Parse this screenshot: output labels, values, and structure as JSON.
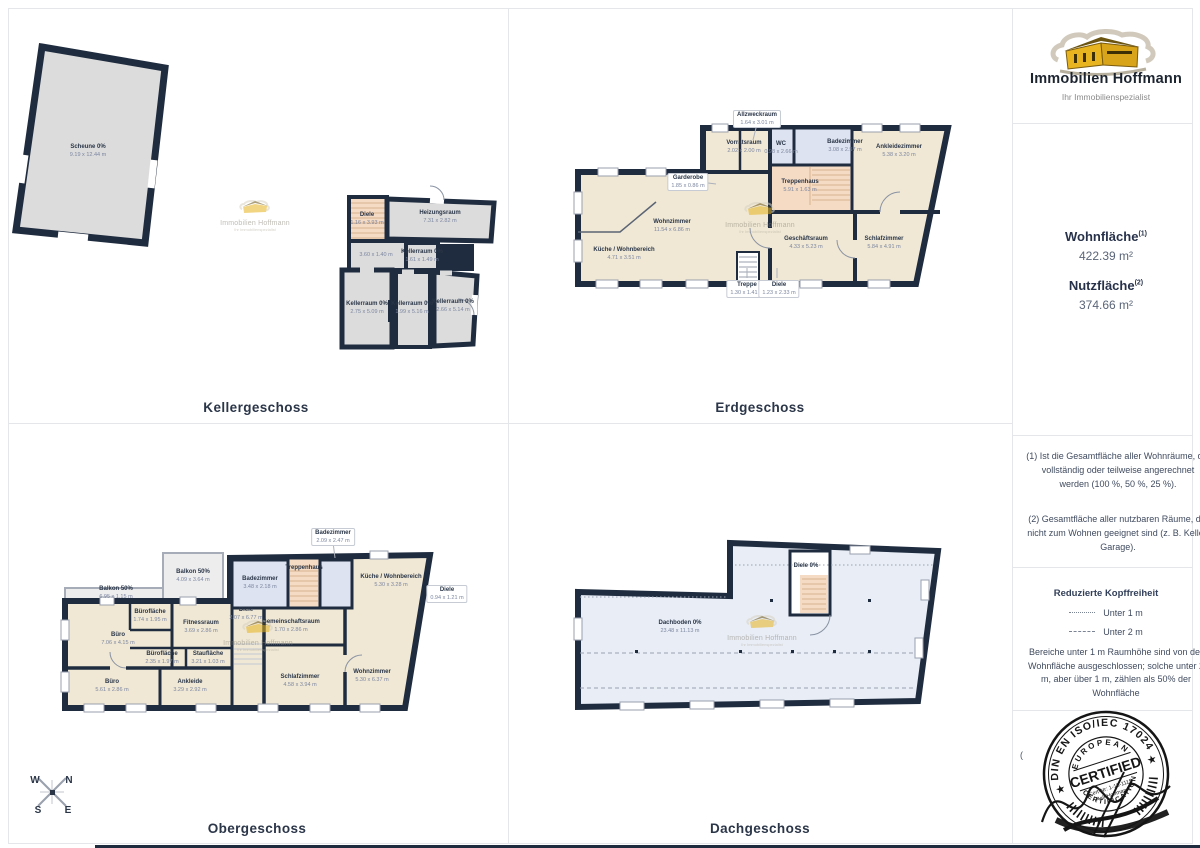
{
  "branding": {
    "name": "Immobilien Hoffmann",
    "tagline": "Ihr Immobilienspezialist"
  },
  "sidebar": {
    "wohnflaeche_label": "Wohnfläche",
    "wohnflaeche_sup": "(1)",
    "wohnflaeche_value": "422.39 m²",
    "nutzflaeche_label": "Nutzfläche",
    "nutzflaeche_sup": "(2)",
    "nutzflaeche_value": "374.66 m²",
    "note1": "(1) Ist die Gesamtfläche aller Wohnräume, die vollständig oder teilweise angerechnet werden (100 %, 50 %, 25 %).",
    "note2": "(2) Gesamtfläche aller nutzbaren Räume, die nicht zum Wohnen geeignet sind (z. B. Keller, Garage).",
    "legend_title": "Reduzierte Kopffreiheit",
    "legend_under1": "Unter 1 m",
    "legend_under2": "Unter 2 m",
    "legend_body": "Bereiche unter 1 m Raumhöhe sind von der Wohnfläche ausgeschlossen; solche unter 2 m, aber über 1 m, zählen als 50% der Wohnfläche"
  },
  "stamp": {
    "arc_top": "DIN EN ISO/IEC 17024",
    "inner_top": "EUROPEAN",
    "center": "CERTIFIED",
    "cert_nr": "Cert-Nr: 1-18-1115",
    "name": "Ralf Hoffmann",
    "inner_bottom": "CERTIFICATION",
    "star": "★",
    "paren": "("
  },
  "compass": {
    "n": "N",
    "e": "E",
    "s": "S",
    "w": "W"
  },
  "colors": {
    "wall": "#1f2c3f",
    "room_cream": "#f0e8d5",
    "room_blue": "#dde3f0",
    "room_grey": "#dcdcdc",
    "stairs_peach": "#f5dbc4",
    "attic": "#e8edf6",
    "logo_yellow": "#e8b41f"
  },
  "floors": {
    "keller": {
      "title": "Kellergeschoss",
      "rooms": [
        {
          "name": "Scheune 0%",
          "dims": "9.19 x 12.44 m"
        },
        {
          "name": "Diele",
          "dims": "1.16 x 3.93 m"
        },
        {
          "name": "Heizungsraum",
          "dims": "7.31 x 2.82 m"
        },
        {
          "name": "",
          "dims": "3.60 x 1.40 m"
        },
        {
          "name": "Kellerraum 0%",
          "dims": "1.61 x 1.49 m"
        },
        {
          "name": "Kellerraum 0%",
          "dims": "2.75 x 5.09 m"
        },
        {
          "name": "Kellerraum 0%",
          "dims": "1.99 x 5.16 m"
        },
        {
          "name": "Kellerraum 0%",
          "dims": "2.66 x 5.14 m"
        }
      ]
    },
    "erdgeschoss": {
      "title": "Erdgeschoss",
      "rooms": [
        {
          "name": "Allzweckraum",
          "dims": "1.64 x 3.01 m"
        },
        {
          "name": "Vorratsraum",
          "dims": "2.02 x 2.00 m"
        },
        {
          "name": "Garderobe",
          "dims": "1.85 x 0.86 m"
        },
        {
          "name": "WC",
          "dims": "0.98 x 2.66 m"
        },
        {
          "name": "Badezimmer",
          "dims": "3.08 x 2.57 m"
        },
        {
          "name": "Ankleidezimmer",
          "dims": "5.38 x 3.20 m"
        },
        {
          "name": "Treppenhaus",
          "dims": "5.91 x 1.63 m"
        },
        {
          "name": "Wohnzimmer",
          "dims": "11.54 x 6.86 m"
        },
        {
          "name": "Küche / Wohnbereich",
          "dims": "4.71 x 3.51 m"
        },
        {
          "name": "Geschäftsraum",
          "dims": "4.33 x 5.23 m"
        },
        {
          "name": "Schlafzimmer",
          "dims": "5.84 x 4.91 m"
        },
        {
          "name": "Treppe",
          "dims": "1.30 x 1.41 m"
        },
        {
          "name": "Diele",
          "dims": "1.23 x 2.33 m"
        }
      ]
    },
    "obergeschoss": {
      "title": "Obergeschoss",
      "rooms": [
        {
          "name": "Balkon 50%",
          "dims": "4.09 x 3.64 m"
        },
        {
          "name": "Balkon 50%",
          "dims": "6.95 x 1.15 m"
        },
        {
          "name": "Badezimmer",
          "dims": "3.48 x 2.18 m"
        },
        {
          "name": "Treppenhaus",
          "dims": ""
        },
        {
          "name": "Badezimmer",
          "dims": "2.09 x 2.47 m"
        },
        {
          "name": "Küche / Wohnbereich",
          "dims": "5.30 x 3.28 m"
        },
        {
          "name": "Diele",
          "dims": "0.94 x 1.21 m"
        },
        {
          "name": "Diele",
          "dims": "2.07 x 6.77 m"
        },
        {
          "name": "Bürofläche",
          "dims": "1.74 x 1.95 m"
        },
        {
          "name": "Fitnessraum",
          "dims": "3.69 x 2.86 m"
        },
        {
          "name": "Büro",
          "dims": "7.06 x 4.15 m"
        },
        {
          "name": "Gemeinschaftsraum",
          "dims": "1.70 x 2.86 m"
        },
        {
          "name": "Bürofläche",
          "dims": "2.35 x 1.97 m"
        },
        {
          "name": "Staufläche",
          "dims": "3.21 x 1.03 m"
        },
        {
          "name": "Büro",
          "dims": "5.61 x 2.86 m"
        },
        {
          "name": "Ankleide",
          "dims": "3.29 x 2.92 m"
        },
        {
          "name": "Schlafzimmer",
          "dims": "4.58 x 3.94 m"
        },
        {
          "name": "Wohnzimmer",
          "dims": "5.30 x 6.37 m"
        }
      ]
    },
    "dachgeschoss": {
      "title": "Dachgeschoss",
      "rooms": [
        {
          "name": "Diele 0%",
          "dims": ""
        },
        {
          "name": "Dachboden 0%",
          "dims": "23.48 x 11.13 m"
        }
      ]
    }
  }
}
